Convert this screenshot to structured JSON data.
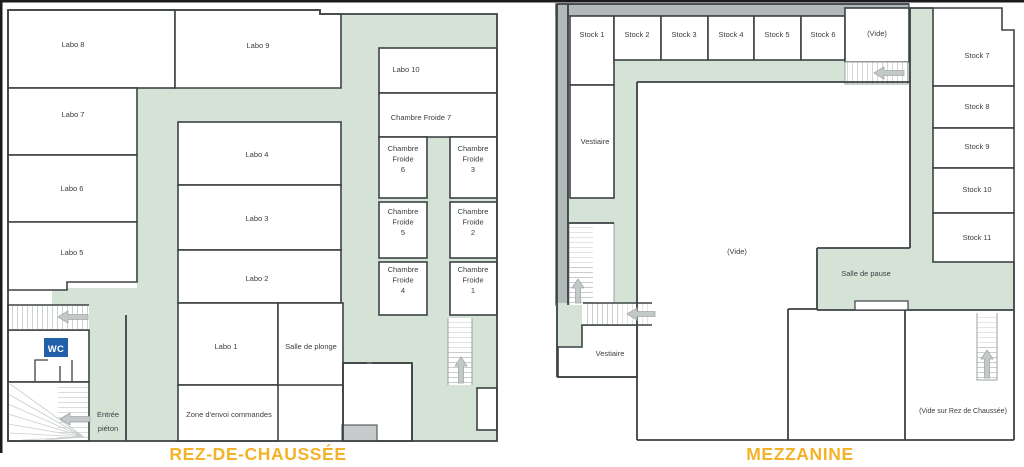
{
  "rdc": {
    "title": "REZ-DE-CHAUSSÉE",
    "labels": {
      "labo1": "Labo 1",
      "labo2": "Labo 2",
      "labo3": "Labo 3",
      "labo4": "Labo 4",
      "labo5": "Labo 5",
      "labo6": "Labo 6",
      "labo7": "Labo 7",
      "labo8": "Labo 8",
      "labo9": "Labo 9",
      "labo10": "Labo 10",
      "chambre_froide_7": "Chambre Froide 7",
      "chambre_froide_6": "Chambre\nFroide\n6",
      "chambre_froide_5": "Chambre\nFroide\n5",
      "chambre_froide_4": "Chambre\nFroide\n4",
      "chambre_froide_3": "Chambre\nFroide\n3",
      "chambre_froide_2": "Chambre\nFroide\n2",
      "chambre_froide_1": "Chambre\nFroide\n1",
      "salle_de_plonge": "Salle de plonge",
      "zone_envoi": "Zone d'envoi commandes",
      "wc": "WC",
      "entree_pieton": "Entrée\npiéton"
    }
  },
  "mezzanine": {
    "title": "MEZZANINE",
    "labels": {
      "stock1": "Stock 1",
      "stock2": "Stock 2",
      "stock3": "Stock 3",
      "stock4": "Stock 4",
      "stock5": "Stock 5",
      "stock6": "Stock 6",
      "stock7": "Stock 7",
      "stock8": "Stock 8",
      "stock9": "Stock 9",
      "stock10": "Stock 10",
      "stock11": "Stock 11",
      "vide_top": "(Vide)",
      "vide_center": "(Vide)",
      "vestiaire_haut": "Vestiaire",
      "vestiaire_bas": "Vestiaire",
      "salle_de_pause": "Salle de pause",
      "vide_sur_rdc": "(Vide sur Rez de Chaussée)"
    }
  },
  "colors": {
    "corridor_green": "#d5e3d7",
    "wall_dark": "#3d4245",
    "band_gray": "#b2b9b9",
    "stair_gray": "#c3c8c8",
    "box_gray": "#c6caca",
    "wc_blue": "#2260aa",
    "title_yellow": "#f3b229",
    "label_text": "#3a3e40"
  }
}
